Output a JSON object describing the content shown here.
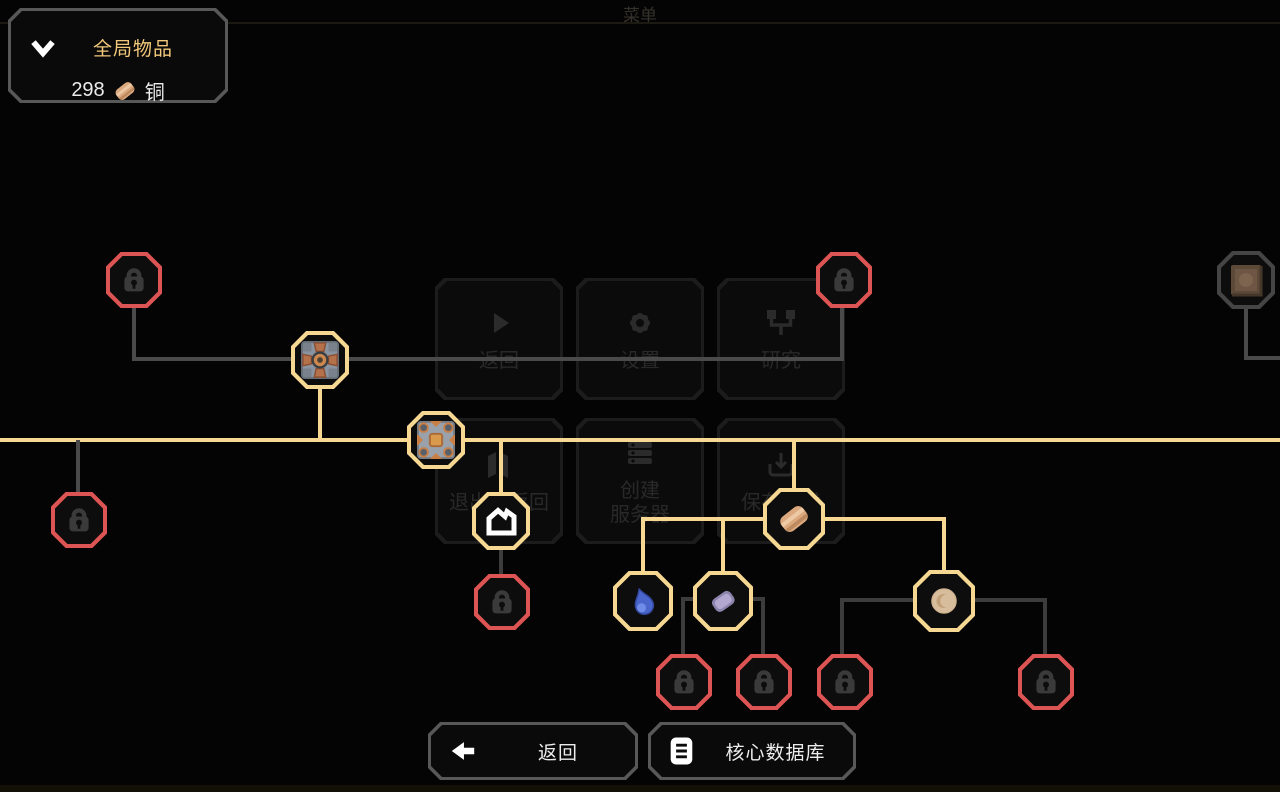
{
  "window": {
    "title": "菜单"
  },
  "inventory_panel": {
    "title": "全局物品",
    "collapse_icon": "chevron-down-icon",
    "items": [
      {
        "count": "298",
        "icon": "copper-icon",
        "name": "铜"
      }
    ]
  },
  "background_menu": {
    "rows": [
      [
        {
          "icon": "play-icon",
          "label": "返回"
        },
        {
          "icon": "gear-icon",
          "label": "设置"
        },
        {
          "icon": "research-icon",
          "label": "研究"
        }
      ],
      [
        {
          "icon": "panes-icon",
          "label": "退出并返回"
        },
        {
          "icon": "server-icon",
          "label": "创建\n服务器"
        },
        {
          "icon": "save-icon",
          "label": "保存游戏"
        }
      ]
    ]
  },
  "tech_tree": {
    "unlocked_nodes": [
      "mechanical-drill",
      "conveyor",
      "core-shard",
      "copper",
      "water",
      "lead",
      "sand"
    ],
    "locked_node_count": 8,
    "dimmed_nodes": [
      "scrap-block"
    ]
  },
  "footer": {
    "back": {
      "icon": "arrow-left-icon",
      "label": "返回"
    },
    "database": {
      "icon": "book-icon",
      "label": "核心数据库"
    }
  },
  "colors": {
    "unlocked_border": "#f6d893",
    "locked_border": "#dd5454",
    "accent_text": "#f2c87a",
    "line_unlocked": "#f6d893",
    "line_locked": "#4a4a4a"
  }
}
